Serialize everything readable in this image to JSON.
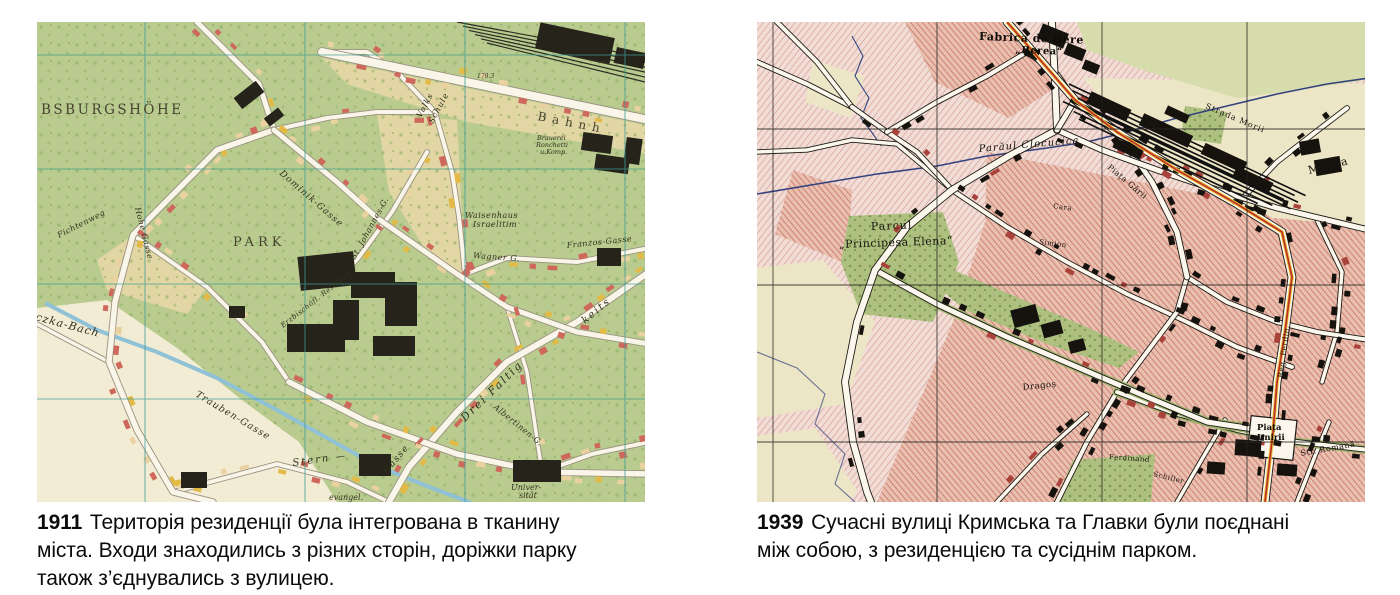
{
  "page": {
    "background": "#ffffff"
  },
  "panels": {
    "left": {
      "year": "1911",
      "caption": "Територія резиденції була інтегрована в тканину\nміста. Входи знаходились з різних сторін, доріжки парку\nтакож з’єднувались з вулицею.",
      "map": {
        "kind": "austro-hungarian-city-plan",
        "palette": {
          "parkGreen": "#b9cb8f",
          "fieldCream": "#e7d8a8",
          "paperPale": "#f2ecd4",
          "buildingRed": "#ce685c",
          "buildingYellow": "#e3ba45",
          "buildingTan": "#ead1a0",
          "buildingBlack": "#26231b",
          "road": "#f9f5e8",
          "roadCasing": "#9a9382",
          "gridTeal": "#3f9d94",
          "stream": "#8fc1d7"
        },
        "labels": [
          {
            "text": "BSBURGSHÖHE",
            "x": 4,
            "y": 92,
            "fs": 13.5,
            "rot": 0,
            "ls": 2.5,
            "cls": "lcaps"
          },
          {
            "text": "PARK",
            "x": 196,
            "y": 224,
            "fs": 13,
            "rot": 0,
            "ls": 4,
            "cls": "lcaps"
          },
          {
            "text": "Volks",
            "x": 384,
            "y": 96,
            "fs": 8,
            "rot": -62,
            "ls": 1,
            "cls": "lst"
          },
          {
            "text": "Schule",
            "x": 396,
            "y": 102,
            "fs": 8,
            "rot": -62,
            "ls": 1,
            "cls": "lst"
          },
          {
            "text": "Waisenhaus",
            "x": 428,
            "y": 196,
            "fs": 8,
            "rot": 0,
            "ls": 0.5,
            "cls": "lst"
          },
          {
            "text": "Israelitim",
            "x": 436,
            "y": 205,
            "fs": 8,
            "rot": 0,
            "ls": 0.5,
            "cls": "lst"
          },
          {
            "text": "Bahnh",
            "x": 500,
            "y": 98,
            "fs": 12,
            "rot": 11,
            "ls": 6,
            "cls": "lcaps"
          },
          {
            "text": "Brauerei",
            "x": 500,
            "y": 118,
            "fs": 6.5,
            "rot": 0,
            "ls": 0,
            "cls": "lst"
          },
          {
            "text": "Ronchetti",
            "x": 499,
            "y": 125,
            "fs": 6.5,
            "rot": 0,
            "ls": 0,
            "cls": "lst"
          },
          {
            "text": "u.Komp.",
            "x": 503,
            "y": 132,
            "fs": 6.5,
            "rot": 0,
            "ls": 0,
            "cls": "lst"
          },
          {
            "text": "czka-Bach",
            "x": -2,
            "y": 298,
            "fs": 11,
            "rot": 15,
            "ls": 1,
            "cls": "lst"
          },
          {
            "text": "Trauben-Gasse",
            "x": 158,
            "y": 374,
            "fs": 9.5,
            "rot": 31,
            "ls": 1,
            "cls": "lst"
          },
          {
            "text": "Drei Faltig",
            "x": 428,
            "y": 400,
            "fs": 11,
            "rot": -44,
            "ls": 2,
            "cls": "lst"
          },
          {
            "text": "keits",
            "x": 548,
            "y": 302,
            "fs": 10,
            "rot": -40,
            "ls": 2,
            "cls": "lst"
          },
          {
            "text": "Gasse",
            "x": 350,
            "y": 452,
            "fs": 9,
            "rot": -50,
            "ls": 1.5,
            "cls": "lst"
          },
          {
            "text": "Stern —",
            "x": 256,
            "y": 444,
            "fs": 10,
            "rot": -8,
            "ls": 2,
            "cls": "lst"
          },
          {
            "text": "Wagner G.",
            "x": 436,
            "y": 236,
            "fs": 8,
            "rot": 4,
            "ls": 0.5,
            "cls": "lst"
          },
          {
            "text": "Franzos-Gasse",
            "x": 530,
            "y": 226,
            "fs": 8,
            "rot": -6,
            "ls": 0.5,
            "cls": "lst"
          },
          {
            "text": "Dominik-Gasse",
            "x": 242,
            "y": 152,
            "fs": 9,
            "rot": 41,
            "ls": 1,
            "cls": "lst"
          },
          {
            "text": "Hohe Gasse",
            "x": 98,
            "y": 186,
            "fs": 8,
            "rot": 76,
            "ls": 0.5,
            "cls": "lst"
          },
          {
            "text": "Fichtenweg",
            "x": 22,
            "y": 216,
            "fs": 8,
            "rot": -27,
            "ls": 0.5,
            "cls": "lst"
          },
          {
            "text": "St. Johannes-G.",
            "x": 318,
            "y": 238,
            "fs": 8,
            "rot": -61,
            "ls": 0.5,
            "cls": "lst"
          },
          {
            "text": "Albertinen-G.",
            "x": 456,
            "y": 386,
            "fs": 8,
            "rot": 39,
            "ls": 0.5,
            "cls": "lst"
          },
          {
            "text": "Univer-",
            "x": 474,
            "y": 468,
            "fs": 8,
            "rot": 0,
            "ls": 0,
            "cls": "lst"
          },
          {
            "text": "sität",
            "x": 482,
            "y": 476,
            "fs": 8,
            "rot": 0,
            "ls": 0,
            "cls": "lst"
          },
          {
            "text": "evangel.",
            "x": 292,
            "y": 478,
            "fs": 8,
            "rot": 0,
            "ls": 0,
            "cls": "lst"
          },
          {
            "text": "Erzbischöfl. Residenz",
            "x": 246,
            "y": 306,
            "fs": 7,
            "rot": -38,
            "ls": 0.5,
            "cls": "lst"
          },
          {
            "text": "178.3",
            "x": 440,
            "y": 56,
            "fs": 6,
            "rot": 0,
            "ls": 0,
            "cls": "lst"
          }
        ]
      }
    },
    "right": {
      "year": "1939",
      "caption": "Сучасні вулиці Кримська та Главки були поєднані\nміж собою, з резиденцією та сусіднім парком.",
      "map": {
        "kind": "romanian-city-plan",
        "palette": {
          "blockRose": "#f1ddd6",
          "blockSalmon": "#e9bfb0",
          "openCream": "#ece5c6",
          "paleGreen": "#d6dcab",
          "parkGreen": "#aec07f",
          "road": "#fbf7ec",
          "casing": "#1c1a16",
          "routeRed": "#c03227",
          "routeYellow": "#e7c43a",
          "stream": "#33427e",
          "grid": "#26241f",
          "buildingBlack": "#16130e"
        },
        "labels": [
          {
            "text": "Fabrica de Bere",
            "x": 222,
            "y": 18,
            "fs": 11,
            "rot": 2,
            "ls": 0.5,
            "cls": "rb"
          },
          {
            "text": "„Berea“",
            "x": 258,
            "y": 31,
            "fs": 10,
            "rot": 2,
            "ls": 0.5,
            "cls": "rb"
          },
          {
            "text": "Parăul Clocucica",
            "x": 222,
            "y": 130,
            "fs": 10,
            "rot": -5,
            "ls": 1,
            "cls": "ri"
          },
          {
            "text": "Parcul",
            "x": 114,
            "y": 208,
            "fs": 11,
            "rot": -2,
            "ls": 1,
            "cls": "rs"
          },
          {
            "text": "„Principesa Elena“",
            "x": 82,
            "y": 226,
            "fs": 11,
            "rot": -2,
            "ls": 0.5,
            "cls": "rs"
          },
          {
            "text": "Moara",
            "x": 552,
            "y": 152,
            "fs": 11,
            "rot": -14,
            "ls": 1,
            "cls": "rs"
          },
          {
            "text": "Piața Gării",
            "x": 350,
            "y": 146,
            "fs": 8,
            "rot": 40,
            "ls": 0.5,
            "cls": "rs"
          },
          {
            "text": "Strada Morii",
            "x": 448,
            "y": 86,
            "fs": 8,
            "rot": 23,
            "ls": 1,
            "cls": "rs"
          },
          {
            "text": "Dragoș",
            "x": 266,
            "y": 368,
            "fs": 8.5,
            "rot": -6,
            "ls": 0.5,
            "cls": "rs"
          },
          {
            "text": "Piața",
            "x": 500,
            "y": 408,
            "fs": 8.5,
            "rot": 0,
            "ls": 0,
            "cls": "rb"
          },
          {
            "text": "Unirii",
            "x": 500,
            "y": 418,
            "fs": 8.5,
            "rot": 0,
            "ls": 0,
            "cls": "rb"
          },
          {
            "text": "Reg. Ferdin.",
            "x": 526,
            "y": 356,
            "fs": 7.5,
            "rot": -83,
            "ls": 0.5,
            "cls": "rs"
          },
          {
            "text": "Str. Romană",
            "x": 544,
            "y": 434,
            "fs": 8,
            "rot": -10,
            "ls": 0.5,
            "cls": "rs"
          },
          {
            "text": "Ferdinand",
            "x": 352,
            "y": 437,
            "fs": 7,
            "rot": 4,
            "ls": 0.5,
            "cls": "rs"
          },
          {
            "text": "Schiller",
            "x": 396,
            "y": 454,
            "fs": 7,
            "rot": 14,
            "ls": 0.5,
            "cls": "rs"
          },
          {
            "text": "Simion",
            "x": 282,
            "y": 222,
            "fs": 7,
            "rot": 7,
            "ls": 0.5,
            "cls": "rs"
          },
          {
            "text": "Cara",
            "x": 296,
            "y": 186,
            "fs": 7,
            "rot": 8,
            "ls": 0.5,
            "cls": "rs"
          }
        ]
      }
    }
  }
}
